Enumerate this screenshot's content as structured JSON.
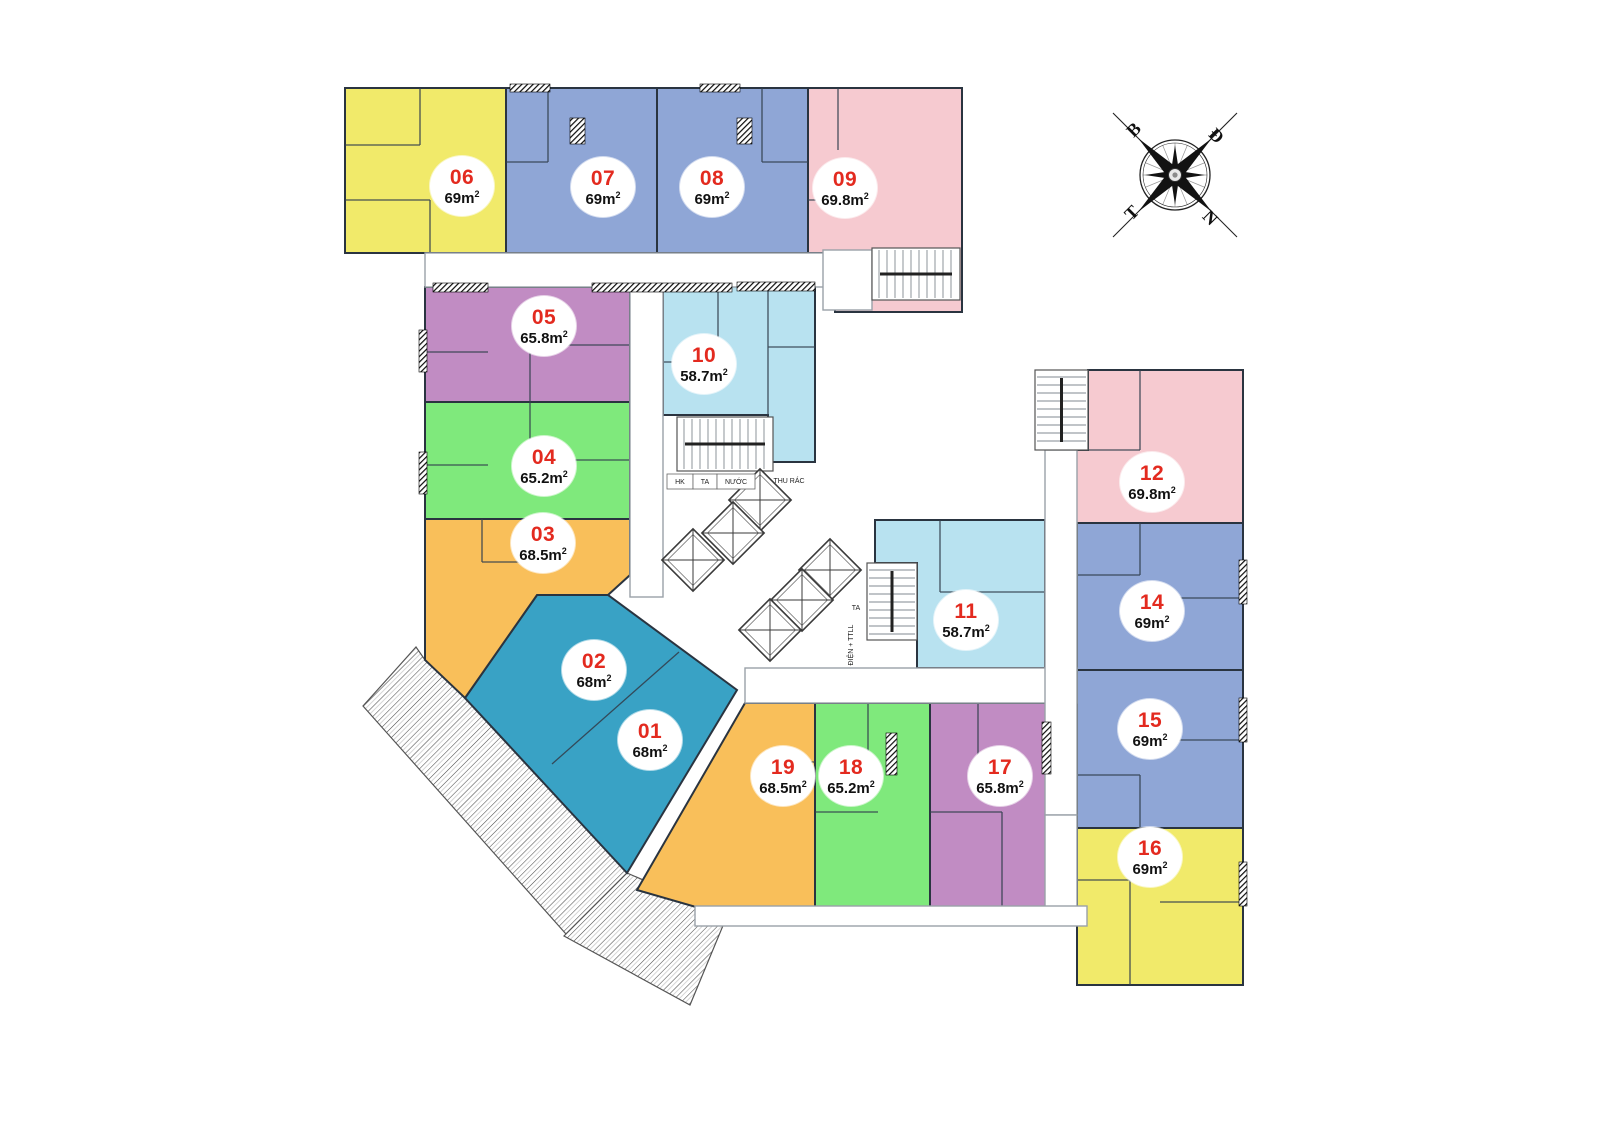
{
  "plan": {
    "unit_number_color": "#E32A1F",
    "area_text_color": "#111111",
    "units": [
      {
        "id": "01",
        "number": "01",
        "area": "68m",
        "sup": "2",
        "color": "#39A2C5"
      },
      {
        "id": "02",
        "number": "02",
        "area": "68m",
        "sup": "2",
        "color": "#39A2C5"
      },
      {
        "id": "03",
        "number": "03",
        "area": "68.5m",
        "sup": "2",
        "color": "#F9BF5A"
      },
      {
        "id": "04",
        "number": "04",
        "area": "65.2m",
        "sup": "2",
        "color": "#7FE97C"
      },
      {
        "id": "05",
        "number": "05",
        "area": "65.8m",
        "sup": "2",
        "color": "#C18CC3"
      },
      {
        "id": "06",
        "number": "06",
        "area": "69m",
        "sup": "2",
        "color": "#F1EA6A"
      },
      {
        "id": "07",
        "number": "07",
        "area": "69m",
        "sup": "2",
        "color": "#8FA6D6"
      },
      {
        "id": "08",
        "number": "08",
        "area": "69m",
        "sup": "2",
        "color": "#8FA6D6"
      },
      {
        "id": "09",
        "number": "09",
        "area": "69.8m",
        "sup": "2",
        "color": "#F6CAD0"
      },
      {
        "id": "10",
        "number": "10",
        "area": "58.7m",
        "sup": "2",
        "color": "#B8E2F0"
      },
      {
        "id": "11",
        "number": "11",
        "area": "58.7m",
        "sup": "2",
        "color": "#B8E2F0"
      },
      {
        "id": "12",
        "number": "12",
        "area": "69.8m",
        "sup": "2",
        "color": "#F6CAD0"
      },
      {
        "id": "14",
        "number": "14",
        "area": "69m",
        "sup": "2",
        "color": "#8FA6D6"
      },
      {
        "id": "15",
        "number": "15",
        "area": "69m",
        "sup": "2",
        "color": "#8FA6D6"
      },
      {
        "id": "16",
        "number": "16",
        "area": "69m",
        "sup": "2",
        "color": "#F1EA6A"
      },
      {
        "id": "17",
        "number": "17",
        "area": "65.8m",
        "sup": "2",
        "color": "#C18CC3"
      },
      {
        "id": "18",
        "number": "18",
        "area": "65.2m",
        "sup": "2",
        "color": "#7FE97C"
      },
      {
        "id": "19",
        "number": "19",
        "area": "68.5m",
        "sup": "2",
        "color": "#F9BF5A"
      }
    ],
    "core_labels": {
      "hk": "HK",
      "ta": "TA",
      "nuoc": "NƯỚC",
      "thu_rac": "THU RÁC",
      "ta2": "TA",
      "dien_ttll": "ĐIỆN + TTLL"
    },
    "compass": {
      "letters": [
        "B",
        "Đ",
        "T",
        "N"
      ]
    }
  }
}
